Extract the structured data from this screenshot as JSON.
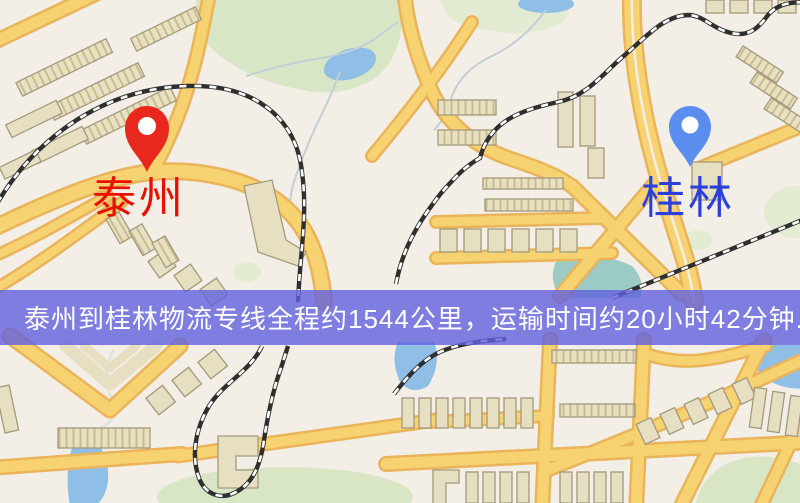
{
  "banner": {
    "text": "泰州到桂林物流专线全程约1544公里，运输时间约20小时42分钟."
  },
  "markers": {
    "origin": {
      "label": "泰州",
      "pin_icon": "map-pin"
    },
    "destination": {
      "label": "桂林",
      "pin_icon": "map-pin"
    }
  },
  "colors": {
    "land": "#f3eee6",
    "park": "#d9e6c6",
    "park-pale": "#e3ecd3",
    "water": "#8fbfe6",
    "water-teal": "#9ccac4",
    "road-fill": "#f7d271",
    "road-casing": "#e9b45b",
    "building": "#e7dfc2",
    "building-stroke": "#a39a7c",
    "rail-dark": "#2f2f2f",
    "banner-bg": "#6260dfcc",
    "banner-text": "#ffffff",
    "pin-origin": "#e9281d",
    "pin-destination": "#5b8dee",
    "origin-label-color": "#e81000",
    "destination-label-color": "#2b3fdd",
    "stream": "#c2cfd6"
  }
}
